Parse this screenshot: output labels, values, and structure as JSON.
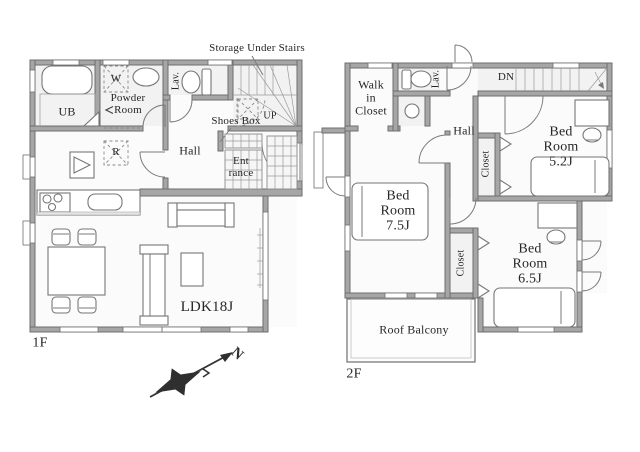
{
  "floor1": {
    "floor_label": "1F",
    "annotations": {
      "storage": "Storage Under Stairs",
      "shoes_box": "Shoes Box",
      "up": "UP"
    },
    "rooms": {
      "ub": "UB",
      "powder": "Powder\nRoom",
      "lav": "Lav.",
      "hall": "Hall",
      "entrance": "Ent\nrance",
      "ldk": "LDK18J"
    },
    "symbols": {
      "washer": "W",
      "fridge": "R"
    }
  },
  "floor2": {
    "floor_label": "2F",
    "annotations": {
      "dn": "DN"
    },
    "rooms": {
      "wic": "Walk\nin\nCloset",
      "lav": "Lav.",
      "hall": "Hall",
      "closet52": "Closet",
      "bed52": "Bed\nRoom\n5.2J",
      "bed75": "Bed\nRoom\n7.5J",
      "closet65": "Closet",
      "bed65": "Bed\nRoom\n6.5J",
      "balcony": "Roof Balcony"
    }
  },
  "compass": {
    "north": "N"
  },
  "colors": {
    "wall": "#a6a6a6",
    "wall_edge": "#6e6e6e",
    "line": "#7a7a7a",
    "text": "#262626",
    "wet_room": "#f2f2f2",
    "floor": "#fbfbfb"
  }
}
